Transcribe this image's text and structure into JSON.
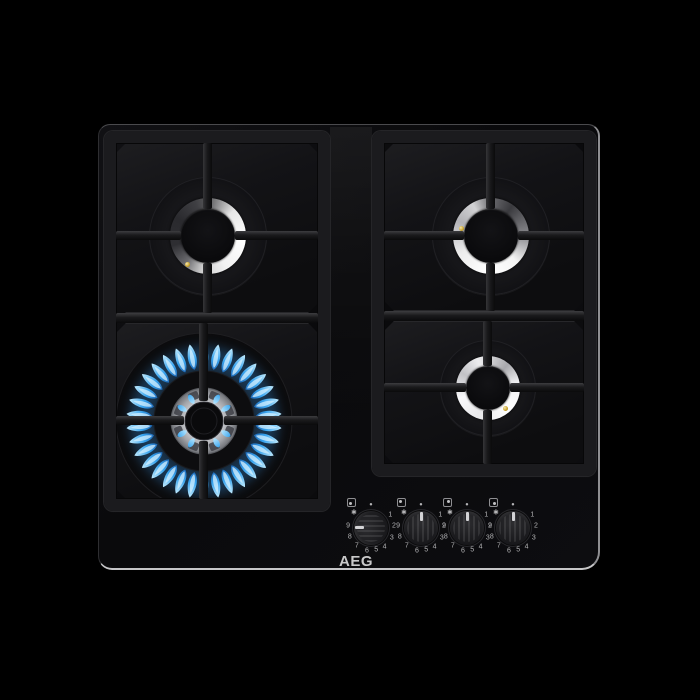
{
  "brand": {
    "logo_text": "AEG"
  },
  "hob": {
    "description": "4-burner gas hob on black glass",
    "glass_color": "#0b0b0d",
    "edge_highlight_color": "#c6c6c8",
    "grate_color": "#1b1b1e"
  },
  "burners": [
    {
      "id": "rear-left",
      "label": "rear left burner",
      "state": "off",
      "size": "medium"
    },
    {
      "id": "front-left",
      "label": "front left wok burner",
      "state": "lit",
      "size": "large"
    },
    {
      "id": "rear-right",
      "label": "rear right burner",
      "state": "off",
      "size": "medium"
    },
    {
      "id": "front-right",
      "label": "front right burner",
      "state": "off",
      "size": "small"
    }
  ],
  "flame": {
    "outer_count": 34,
    "inner_count": 12,
    "notch_count": 8,
    "color_base": "#1b5fae",
    "color_mid": "#37a3ee",
    "color_tip": "#c2ecff",
    "color_core": "rgba(215,242,255,0.75)",
    "glow_color": "#2f8fe0",
    "crown_color": "#d2d3d7"
  },
  "knobs": [
    {
      "id": "knob-front-left",
      "controls": "front-left",
      "position_dot": "bottom-left",
      "state": "on-high",
      "rotation_deg": -90
    },
    {
      "id": "knob-rear-left",
      "controls": "rear-left",
      "position_dot": "top-left",
      "state": "off",
      "rotation_deg": 0
    },
    {
      "id": "knob-rear-right",
      "controls": "rear-right",
      "position_dot": "top-right",
      "state": "off",
      "rotation_deg": 0
    },
    {
      "id": "knob-front-right",
      "controls": "front-right",
      "position_dot": "bottom-right",
      "state": "off",
      "rotation_deg": 0
    }
  ],
  "dial": {
    "marks": [
      {
        "label": "•",
        "angle": 0
      },
      {
        "label": "1",
        "angle": 57
      },
      {
        "label": "2",
        "angle": 86
      },
      {
        "label": "3",
        "angle": 115
      },
      {
        "label": "4",
        "angle": 144
      },
      {
        "label": "5",
        "angle": 167
      },
      {
        "label": "6",
        "angle": 190
      },
      {
        "label": "7",
        "angle": 218
      },
      {
        "label": "8",
        "angle": 247
      },
      {
        "label": "9",
        "angle": 276
      },
      {
        "label": "✱",
        "angle": 312
      }
    ]
  }
}
